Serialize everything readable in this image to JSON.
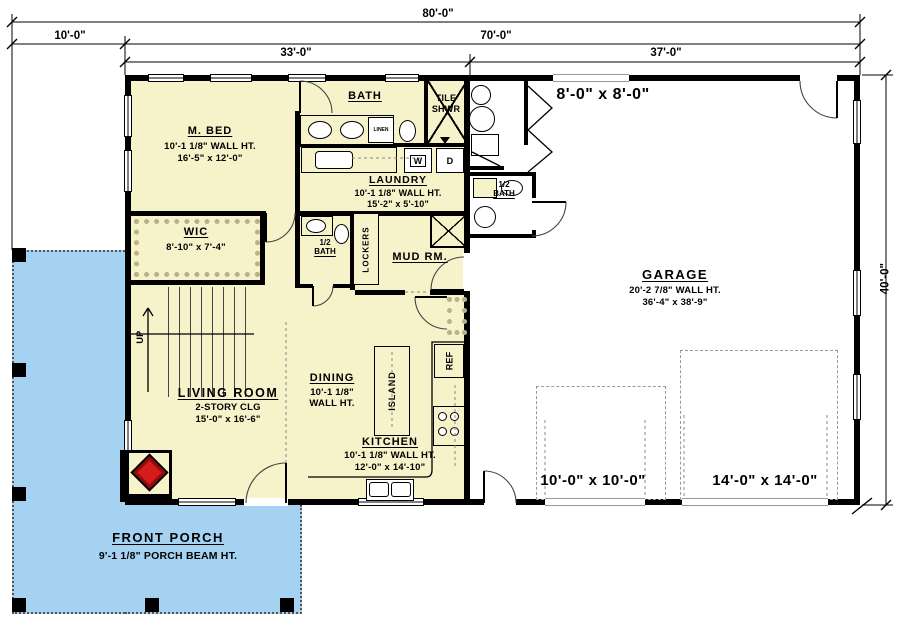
{
  "dim": {
    "overall": "80'-0\"",
    "porch_depth": "10'-0\"",
    "main": "70'-0\"",
    "house_width": "33'-0\"",
    "garage_width": "37'-0\"",
    "garage_depth": "40'-0\""
  },
  "rooms": {
    "mbed": {
      "name": "M. BED",
      "ht": "10'-1 1/8\" WALL HT.",
      "size": "16'-5\" x 12'-0\""
    },
    "bath": {
      "name": "BATH"
    },
    "tileshwr": {
      "l1": "TILE",
      "l2": "SHWR"
    },
    "laundry": {
      "name": "LAUNDRY",
      "ht": "10'-1 1/8\" WALL HT.",
      "size": "15'-2\" x 5'-10\""
    },
    "wic": {
      "name": "WIC",
      "size": "8'-10\" x 7'-4\""
    },
    "halfbath1": {
      "l1": "1/2",
      "l2": "BATH"
    },
    "lockers": "LOCKERS",
    "mudrm": "MUD RM.",
    "living": {
      "name": "LIVING ROOM",
      "clg": "2-STORY CLG",
      "size": "15'-0\" x 16'-6\""
    },
    "dining": {
      "name": "DINING",
      "ht1": "10'-1 1/8\"",
      "ht2": "WALL HT."
    },
    "island": "ISLAND",
    "kitchen": {
      "name": "KITCHEN",
      "ht": "10'-1 1/8\" WALL HT.",
      "size": "12'-0\" x 14'-10\""
    },
    "garage": {
      "name": "GARAGE",
      "ht": "20'-2 7/8\" WALL HT.",
      "size": "36'-4\" x 38'-9\"",
      "rear_door": "8'-0\" x 8'-0\""
    },
    "halfbath2": {
      "l1": "1/2",
      "l2": "BATH"
    },
    "porch": {
      "name": "FRONT PORCH",
      "ht": "9'-1 1/8\" PORCH BEAM HT."
    }
  },
  "labels": {
    "washer": "W",
    "dryer": "D",
    "ref": "REF",
    "up": "UP",
    "linen": "LINEN",
    "garage_door1": "10'-0\" x 10'-0\"",
    "garage_door2": "14'-0\" x 14'-0\""
  },
  "colors": {
    "house_fill": "#f6f2ca",
    "porch_fill": "#a6d2f2",
    "wall": "#000000",
    "fireplace_red": "#d41c1c"
  }
}
